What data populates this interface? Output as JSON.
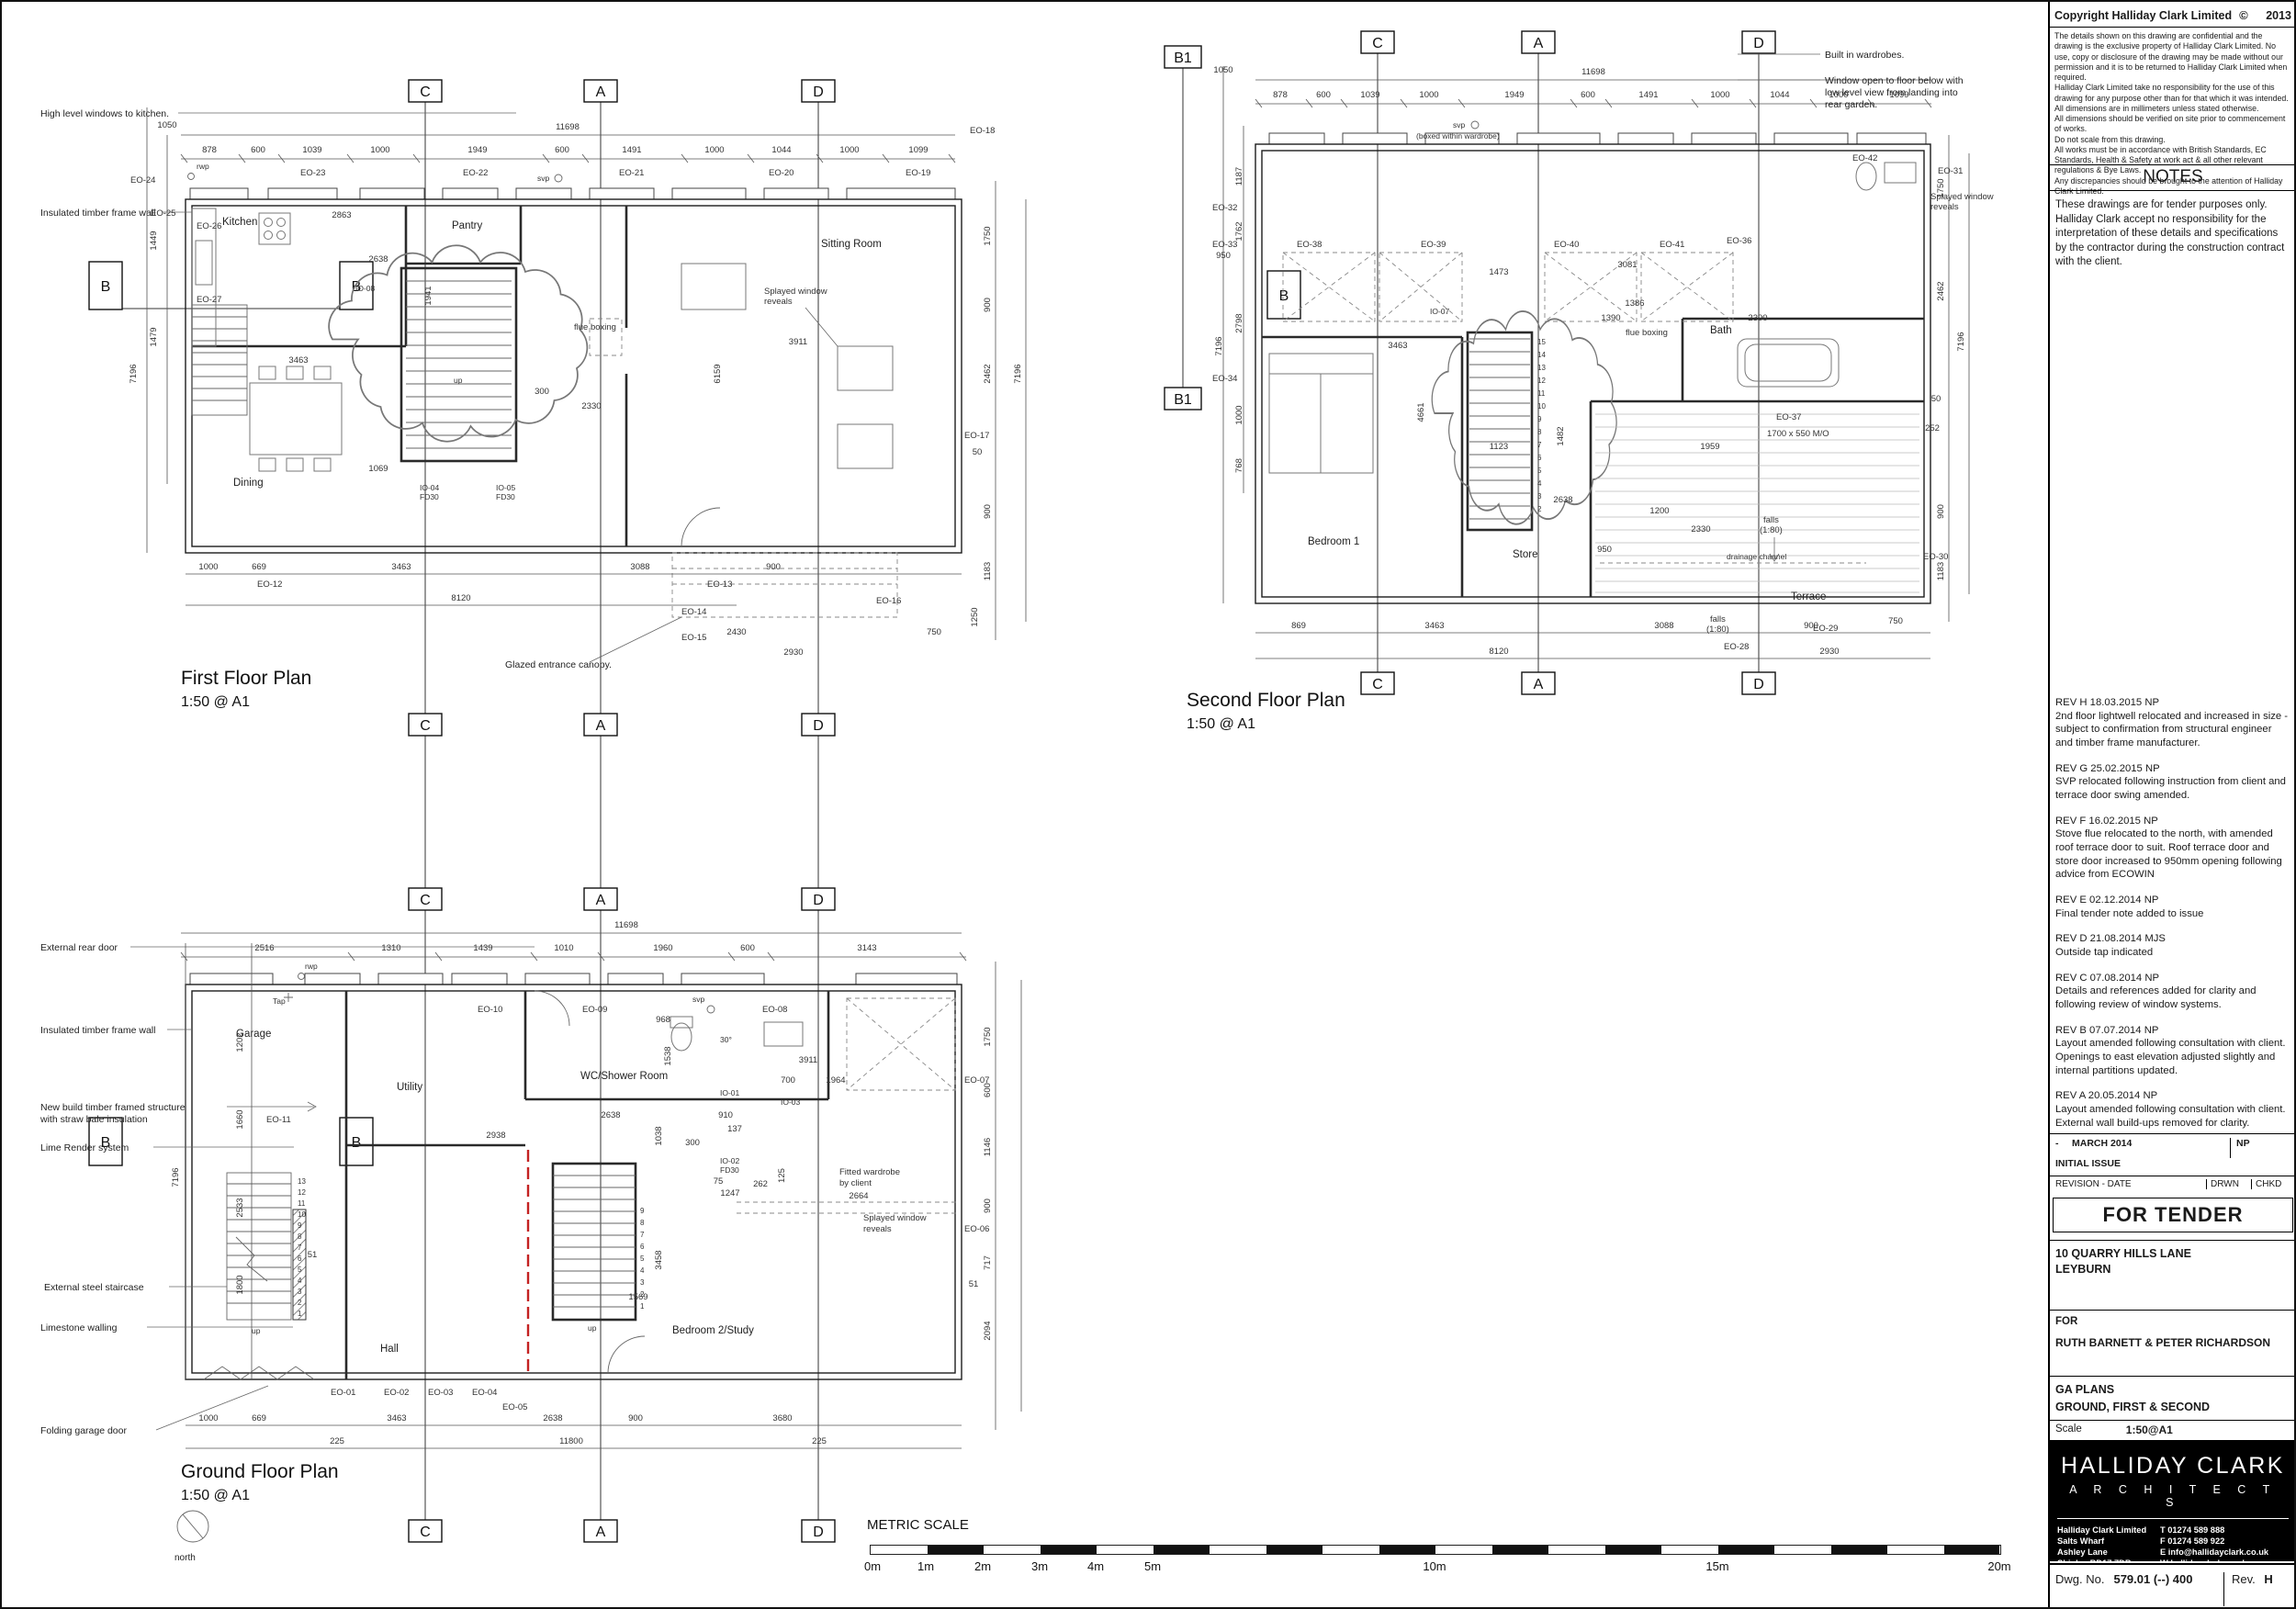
{
  "tb": {
    "copyright_title": "Copyright Halliday Clark Limited",
    "copyright_sym": "©",
    "copyright_year": "2013",
    "cp": [
      "The details shown on this drawing are confidential and the drawing is the exclusive property of Halliday Clark Limited.  No use, copy or disclosure of the drawing may be made without our permission and it is to be returned to Halliday Clark Limited when required.",
      "Halliday Clark Limited take no responsibility for the use of this drawing for any purpose other than for that which it was intended.",
      "All dimensions are in millimeters unless stated otherwise.",
      "All dimensions should be verified on site prior to commencement of works.",
      "Do not scale from this drawing.",
      "All works must be in accordance with British Standards, EC Standards, Health & Safety at work act & all other relevant regulations & Bye Laws.",
      "Any discrepancies should be brought to the attention of Halliday Clark Limited."
    ],
    "notes_heading": "NOTES",
    "notes_body": "These drawings are for tender purposes only. Halliday Clark accept no responsibility for the interpretation of these details and specifications by the contractor during the construction contract with the client.",
    "revs": [
      {
        "label": "REV H 18.03.2015 NP",
        "text": "2nd floor lightwell relocated and increased in size - subject to confirmation from structural engineer and timber frame manufacturer."
      },
      {
        "label": "REV G 25.02.2015 NP",
        "text": "SVP relocated following instruction from client and terrace door swing amended."
      },
      {
        "label": "REV F 16.02.2015 NP",
        "text": "Stove flue relocated to the north, with amended roof terrace door to suit. Roof terrace door and store door increased to 950mm opening following advice from ECOWIN"
      },
      {
        "label": "REV E 02.12.2014 NP",
        "text": "Final tender note added to issue"
      },
      {
        "label": "REV D 21.08.2014 MJS",
        "text": "Outside tap indicated"
      },
      {
        "label": "REV C 07.08.2014 NP",
        "text": "Details and references added for clarity and following review of window systems."
      },
      {
        "label": "REV B 07.07.2014 NP",
        "text": "Layout amended following consultation with client. Openings to east elevation adjusted slightly and internal partitions updated."
      },
      {
        "label": "REV A 20.05.2014 NP",
        "text": "Layout amended following consultation with client. External wall build-ups removed for clarity."
      }
    ],
    "issue_dash": "-",
    "issue_date": "MARCH 2014",
    "issue_drwn": "NP",
    "issue_name": "INITIAL ISSUE",
    "col_rev": "REVISION - DATE",
    "col_drwn": "DRWN",
    "col_chkd": "CHKD",
    "tender": "FOR TENDER",
    "project1": "10 QUARRY HILLS LANE",
    "project2": "LEYBURN",
    "for_label": "FOR",
    "client": "RUTH BARNETT & PETER RICHARDSON",
    "dwg1": "GA PLANS",
    "dwg2": "GROUND, FIRST & SECOND",
    "scale_label": "Scale",
    "scale_value": "1:50@A1",
    "logo1": "HALLIDAY CLARK",
    "logo2": "A R C H I T E C T S",
    "addr": [
      "Halliday Clark Limited",
      "Salts Wharf",
      "Ashley Lane",
      "Shipley  BD17 7DB"
    ],
    "contact": [
      "T  01274 589 888",
      "F  01274 589 922",
      "E  info@hallidayclark.co.uk",
      "W  hallidayclark.co.uk"
    ],
    "dwgno_label": "Dwg. No.",
    "dwgno": "579.01 (--) 400",
    "rev_label": "Rev.",
    "rev": "H"
  },
  "sb": {
    "title": "METRIC SCALE",
    "labels": [
      "0m",
      "1m",
      "2m",
      "3m",
      "4m",
      "5m",
      "10m",
      "15m",
      "20m"
    ]
  },
  "ff": {
    "title": "First Floor Plan",
    "scale": "1:50 @ A1",
    "mk_c": "C",
    "mk_a": "A",
    "mk_d": "D",
    "mk_b": "B",
    "room_kitchen": "Kitchen",
    "room_pantry": "Pantry",
    "room_sitting": "Sitting Room",
    "room_dining": "Dining",
    "n_high": "High level windows to kitchen.",
    "n_timber": "Insulated timber frame wall",
    "n_splayed1": "Splayed window",
    "n_splayed2": "reveals",
    "n_flue": "flue boxing",
    "n_canopy": "Glazed entrance canopy.",
    "n_svp": "svp",
    "n_rwp": "rwp",
    "n_up": "up",
    "dim_total": "11698",
    "dim_pre": "1050",
    "dims_top": [
      "878",
      "600",
      "1039",
      "1000",
      "1949",
      "600",
      "1491",
      "1000",
      "1044",
      "1000",
      "1099"
    ],
    "dims_left": [
      "1449",
      "1479",
      "7196"
    ],
    "dims_right": [
      "1750",
      "900",
      "2462",
      "7196",
      "50",
      "900",
      "1183",
      "1250",
      "750"
    ],
    "dims_bottom": [
      "1000",
      "669",
      "3463",
      "3088",
      "900"
    ],
    "dim_overall": "8120",
    "dim_c1": "2430",
    "dim_c2": "2930",
    "dims_inner": [
      "3463",
      "2863",
      "2638",
      "1069",
      "300",
      "2330",
      "3911",
      "6159",
      "1941"
    ],
    "eo_top": [
      "EO-23",
      "EO-22",
      "EO-21",
      "EO-20",
      "EO-19"
    ],
    "eo_left": [
      "EO-24",
      "EO-25",
      "EO-26",
      "EO-27"
    ],
    "eo_bottom": [
      "EO-12",
      "EO-13",
      "EO-14",
      "EO-15",
      "EO-16"
    ],
    "eo_right": [
      "EO-18",
      "EO-17"
    ],
    "io": [
      "IO-08",
      "IO-04",
      "FD30",
      "IO-05",
      "FD30"
    ]
  },
  "sf": {
    "title": "Second Floor Plan",
    "scale": "1:50 @ A1",
    "mk_b1": "B1",
    "mk_c": "C",
    "mk_a": "A",
    "mk_d": "D",
    "mk_b": "B",
    "room_bed": "Bedroom 1",
    "room_store": "Store",
    "room_bath": "Bath",
    "room_terrace": "Terrace",
    "n_ward": "Built in wardrobes.",
    "n_win1": "Window open to floor below with",
    "n_win2": "low level view from landing into",
    "n_win3": "rear garden.",
    "n_falls1": "falls",
    "n_falls2": "(1:80)",
    "n_drain": "drainage channel",
    "n_svp": "svp",
    "n_svp2": "(boxed within wardrobe)",
    "n_flue": "flue boxing",
    "n_splayed1": "Splayed window",
    "n_splayed2": "reveals",
    "n_mo": "1700 x 550 M/O",
    "dim_total": "11698",
    "dim_pre": "1050",
    "dims_top": [
      "878",
      "600",
      "1039",
      "1000",
      "1949",
      "600",
      "1491",
      "1000",
      "1044",
      "1000",
      "1099"
    ],
    "dims_left": [
      "1187",
      "1762",
      "2798",
      "1000",
      "768",
      "7196"
    ],
    "dims_right": [
      "1750",
      "2462",
      "7196",
      "50",
      "252",
      "900",
      "1183",
      "750"
    ],
    "dims_bottom": [
      "869",
      "3463",
      "3088",
      "900"
    ],
    "dim_overall": "8120",
    "dim_r2": "2930",
    "dims_inner": [
      "3463",
      "1473",
      "3081",
      "4661",
      "1123",
      "2638",
      "1386",
      "1390",
      "1482",
      "1959",
      "2300",
      "2330",
      "1200",
      "950"
    ],
    "eo_top": [
      "EO-38",
      "EO-39",
      "EO-40",
      "EO-41",
      "EO-42"
    ],
    "eo_left": [
      "EO-32",
      "EO-33",
      "EO-34"
    ],
    "eo_left_dim": "950",
    "eo_right": [
      "EO-31",
      "EO-36",
      "EO-37",
      "EO-30",
      "EO-29"
    ],
    "eo_bottom": [
      "EO-28"
    ],
    "io": [
      "IO-07"
    ],
    "stairs": [
      "15",
      "14",
      "13",
      "12",
      "11",
      "10",
      "9",
      "8",
      "7",
      "6",
      "5",
      "4",
      "3",
      "2"
    ]
  },
  "gf": {
    "title": "Ground Floor Plan",
    "scale": "1:50 @ A1",
    "north": "north",
    "mk_c": "C",
    "mk_a": "A",
    "mk_d": "D",
    "mk_b": "B",
    "room_garage": "Garage",
    "room_utility": "Utility",
    "room_wc": "WC/Shower Room",
    "room_hall": "Hall",
    "room_bed": "Bedroom 2/Study",
    "n_rear": "External rear door",
    "n_timber": "Insulated timber frame wall",
    "n_struct1": "New build timber framed structure",
    "n_struct2": "with straw bale insulation",
    "n_lime": "Lime Render system",
    "n_stair": "External steel staircase",
    "n_limestone": "Limestone walling",
    "n_garage": "Folding garage door",
    "n_ward1": "Fitted wardrobe",
    "n_ward2": "by client",
    "n_splayed1": "Splayed window",
    "n_splayed2": "reveals",
    "n_tap": "Tap",
    "n_rwp": "rwp",
    "n_svp": "svp",
    "n_up": "up",
    "n_deg": "30°",
    "dim_total": "11698",
    "dims_top": [
      "2516",
      "1310",
      "1439",
      "1010",
      "1960",
      "600",
      "3143"
    ],
    "dims_left": [
      "1202",
      "1660",
      "7196",
      "2533",
      "1800",
      "51"
    ],
    "dims_right": [
      "1750",
      "600",
      "1146",
      "900",
      "717",
      "2094",
      "51"
    ],
    "dims_bottom": [
      "1000",
      "669",
      "3463",
      "2638",
      "900",
      "3680"
    ],
    "dims_bottom2": [
      "225",
      "11800",
      "225"
    ],
    "dims_inner": [
      "968",
      "1538",
      "2638",
      "2938",
      "1038",
      "300",
      "910",
      "137",
      "75",
      "1247",
      "262",
      "125",
      "700",
      "1964",
      "3911",
      "2664",
      "3458",
      "1569"
    ],
    "eo_top": [
      "EO-10",
      "EO-09",
      "EO-08"
    ],
    "eo_left": [
      "EO-11"
    ],
    "eo_right": [
      "EO-07",
      "EO-06"
    ],
    "eo_bottom": [
      "EO-01",
      "EO-02",
      "EO-03",
      "EO-04",
      "EO-05"
    ],
    "io": [
      "IO-01",
      "IO-02",
      "FD30",
      "IO-03"
    ],
    "stairs": [
      "13",
      "12",
      "11",
      "10",
      "9",
      "8",
      "7",
      "6",
      "5",
      "4",
      "3",
      "2",
      "1"
    ],
    "stairs_int": [
      "9",
      "8",
      "7",
      "6",
      "5",
      "4",
      "3",
      "2",
      "1"
    ]
  }
}
